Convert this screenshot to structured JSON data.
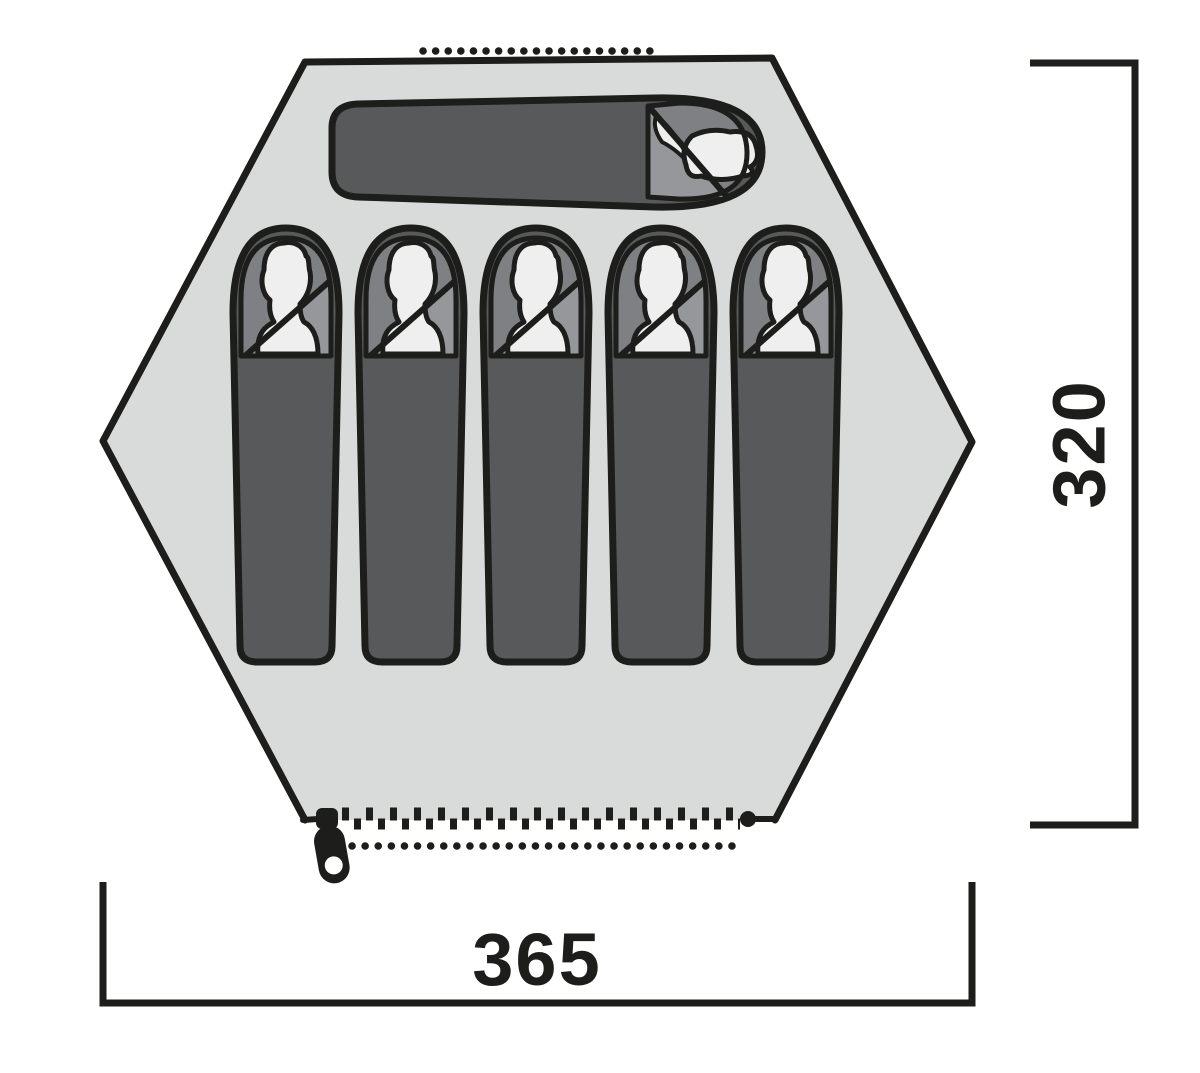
{
  "diagram": {
    "title": "tent floor plan (top view)",
    "dimensions": {
      "height_label": "320",
      "width_label": "365"
    },
    "tent": {
      "shape": "hexagon",
      "sleeping_bags_horizontal": 1,
      "sleeping_bags_vertical": 5,
      "features": [
        "roof-vent-dotted-line",
        "entrance-zipper-with-pull",
        "entrance-dotted-line"
      ]
    },
    "colors": {
      "floor": "#d9dbda",
      "outline": "#1d1d1b",
      "bag_body": "#58595b",
      "bag_head_area": "#7e8083",
      "bag_flap": "#95979a",
      "person": "#efefef",
      "background": "#ffffff"
    }
  }
}
